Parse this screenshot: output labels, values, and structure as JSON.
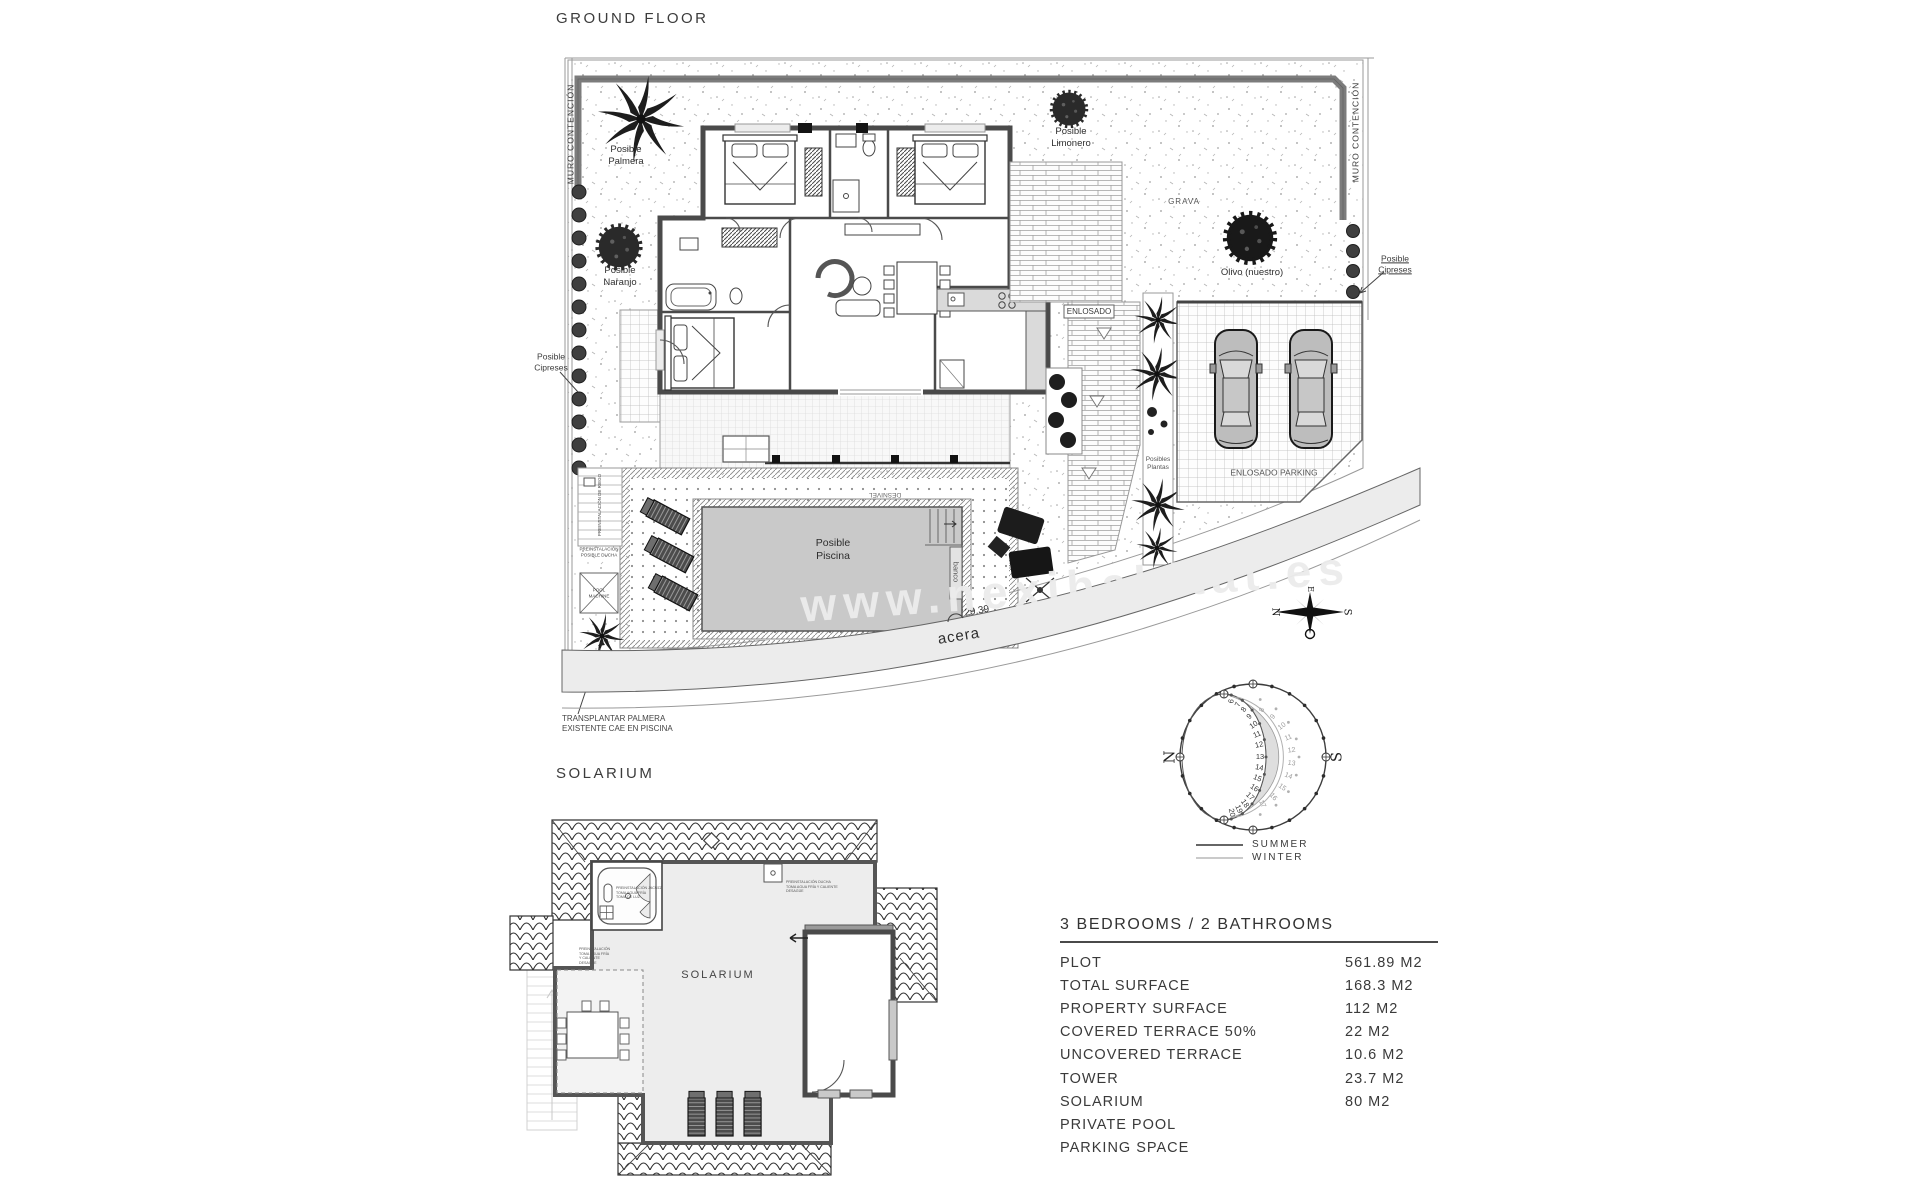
{
  "page": {
    "title_ground": "GROUND FLOOR",
    "title_solarium": "SOLARIUM",
    "watermark": "www.nexihabitat.es"
  },
  "ground_floor": {
    "walls": {
      "muro_left": "MURO CONTENCIÓN",
      "muro_right": "MURO CONTENCIÓN"
    },
    "vegetation": {
      "palmera": "Posible\nPalmera",
      "naranjo": "Posible\nNaranjo",
      "limonero": "Posible\nLimonero",
      "olivo": "Olivo (nuestro)",
      "cipreses_left": "Posible\nCipreses",
      "cipreses_right": "Posible\nCipreses",
      "plantas": "Posibles\nPlantas",
      "grava": "GRAVA"
    },
    "paving": {
      "enlosado": "ENLOSADO",
      "enlosado_parking": "ENLOSADO PARKING",
      "acera": "acera",
      "dimension": "29.39"
    },
    "pool": {
      "label": "Posible\nPiscina",
      "banco": "banco",
      "desnivel": "DESNIVEL",
      "pool_machine": "POOL\nMACHINE",
      "preinst_ducha": "PREINSTALACIÓN\nPOSIBLE DUCHA",
      "preinst_riego": "PREINSTALACIÓN DE RIEGO",
      "transplantar": "TRANSPLANTAR PALMERA\nEXISTENTE  CAE EN PISCINA"
    }
  },
  "compass": {
    "n": "N",
    "e": "E",
    "s": "S",
    "o": "O"
  },
  "sun_diagram": {
    "north": "N",
    "south": "S",
    "summer_hours": [
      "6",
      "7",
      "8",
      "9",
      "10",
      "11",
      "12",
      "13",
      "14",
      "15",
      "16",
      "17",
      "18",
      "19",
      "20"
    ],
    "winter_hours": [
      "8",
      "9",
      "10",
      "11",
      "12",
      "13",
      "14",
      "15",
      "16",
      "17"
    ],
    "legend": {
      "summer": "SUMMER",
      "winter": "WINTER"
    }
  },
  "solarium": {
    "room_label": "SOLARIUM",
    "jacuzzi_note": "PREINSTALACIÓN JACUZZI\nTOMA AGUA FRÍA\nTOMA DE LUZ",
    "shower_note": "PREINSTALACIÓN DUCHA\nTOMA AGUA FRÍA Y CALIENTE\nDESAGÜE",
    "pergola_note": "PREINSTALACIÓN\nTOMA AGUA FRÍA\nY CALIENTE\nDESAGÜE"
  },
  "table": {
    "heading": "3 BEDROOMS / 2 BATHROOMS",
    "rows": [
      {
        "label": "PLOT",
        "value": "561.89 M2"
      },
      {
        "label": "TOTAL SURFACE",
        "value": "168.3 M2"
      },
      {
        "label": "PROPERTY SURFACE",
        "value": "112 M2"
      },
      {
        "label": "COVERED TERRACE 50%",
        "value": "22 M2"
      },
      {
        "label": "UNCOVERED TERRACE",
        "value": "10.6 M2"
      },
      {
        "label": "TOWER",
        "value": "23.7 M2"
      },
      {
        "label": "SOLARIUM",
        "value": "80 M2"
      },
      {
        "label": "PRIVATE POOL",
        "value": ""
      },
      {
        "label": "PARKING SPACE",
        "value": ""
      }
    ]
  }
}
